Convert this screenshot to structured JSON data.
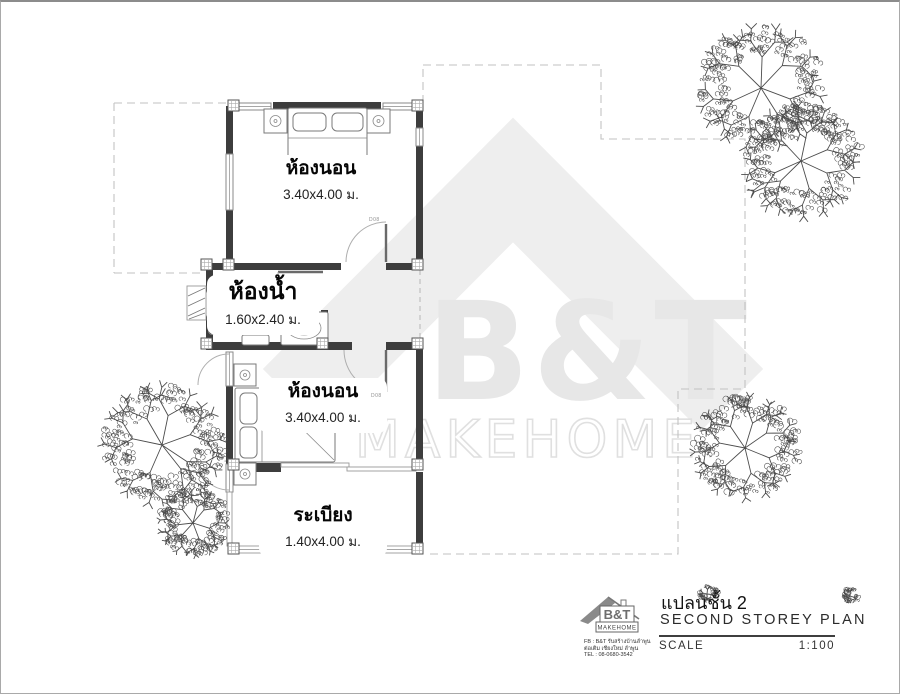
{
  "watermark": {
    "brand": "B&T",
    "word": "MAKEHOME",
    "color": "#e7e7e7"
  },
  "rooms": [
    {
      "id": "bedroom-1",
      "name": "ห้องนอน",
      "size": "3.40x4.00 ม."
    },
    {
      "id": "bathroom",
      "name": "ห้องน้ำ",
      "size": "1.60x2.40 ม."
    },
    {
      "id": "bedroom-2",
      "name": "ห้องนอน",
      "size": "3.40x4.00 ม."
    },
    {
      "id": "balcony",
      "name": "ระเบียง",
      "size": "1.40x4.00 ม."
    }
  ],
  "door_labels": {
    "bedroom1": "D08",
    "bedroom2": "D08"
  },
  "title_block": {
    "title_th": "แปลนชั้น 2",
    "title_en": "SECOND STOREY PLAN",
    "scale_label": "SCALE",
    "scale_value": "1:100",
    "logo": {
      "brand": "B&T",
      "word": "MAKEHOME",
      "line1": "FB : B&T รับสร้างบ้านลำพูน",
      "line2": "ต่อเติม เชียงใหม่ ลำพูน",
      "line3": "TEL : 08-0680-3542"
    }
  },
  "colors": {
    "wall": "#3d3d3d",
    "dash": "#c2c2c2",
    "tree": "#4c4c4c",
    "text": "#1a1a1a"
  }
}
